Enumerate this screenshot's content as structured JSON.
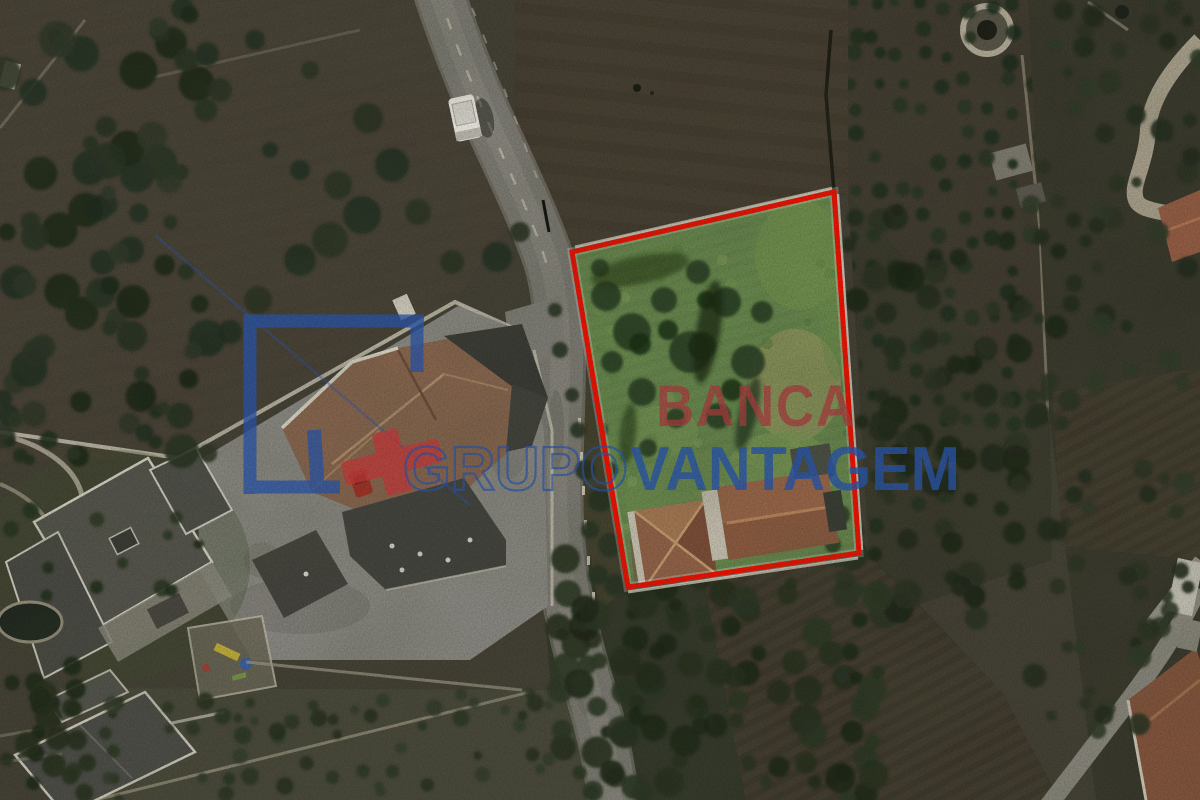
{
  "scene": {
    "kind": "satellite-aerial-photo",
    "description": "Aerial satellite photo of a rural parcel with a land plot outlined in red and a real-estate brand watermark"
  },
  "plot": {
    "boundary_points": "572,252 834,192 859,553 628,587",
    "boundary_color": "#f21000"
  },
  "watermark": {
    "banca_text": "BANCA",
    "grupo_text": "GRUPO",
    "vantagem_text": "VANTAGEM",
    "banca_color": "#a73f3f",
    "blue_color": "#2b56a8",
    "cross_color": "#c23b3b"
  }
}
